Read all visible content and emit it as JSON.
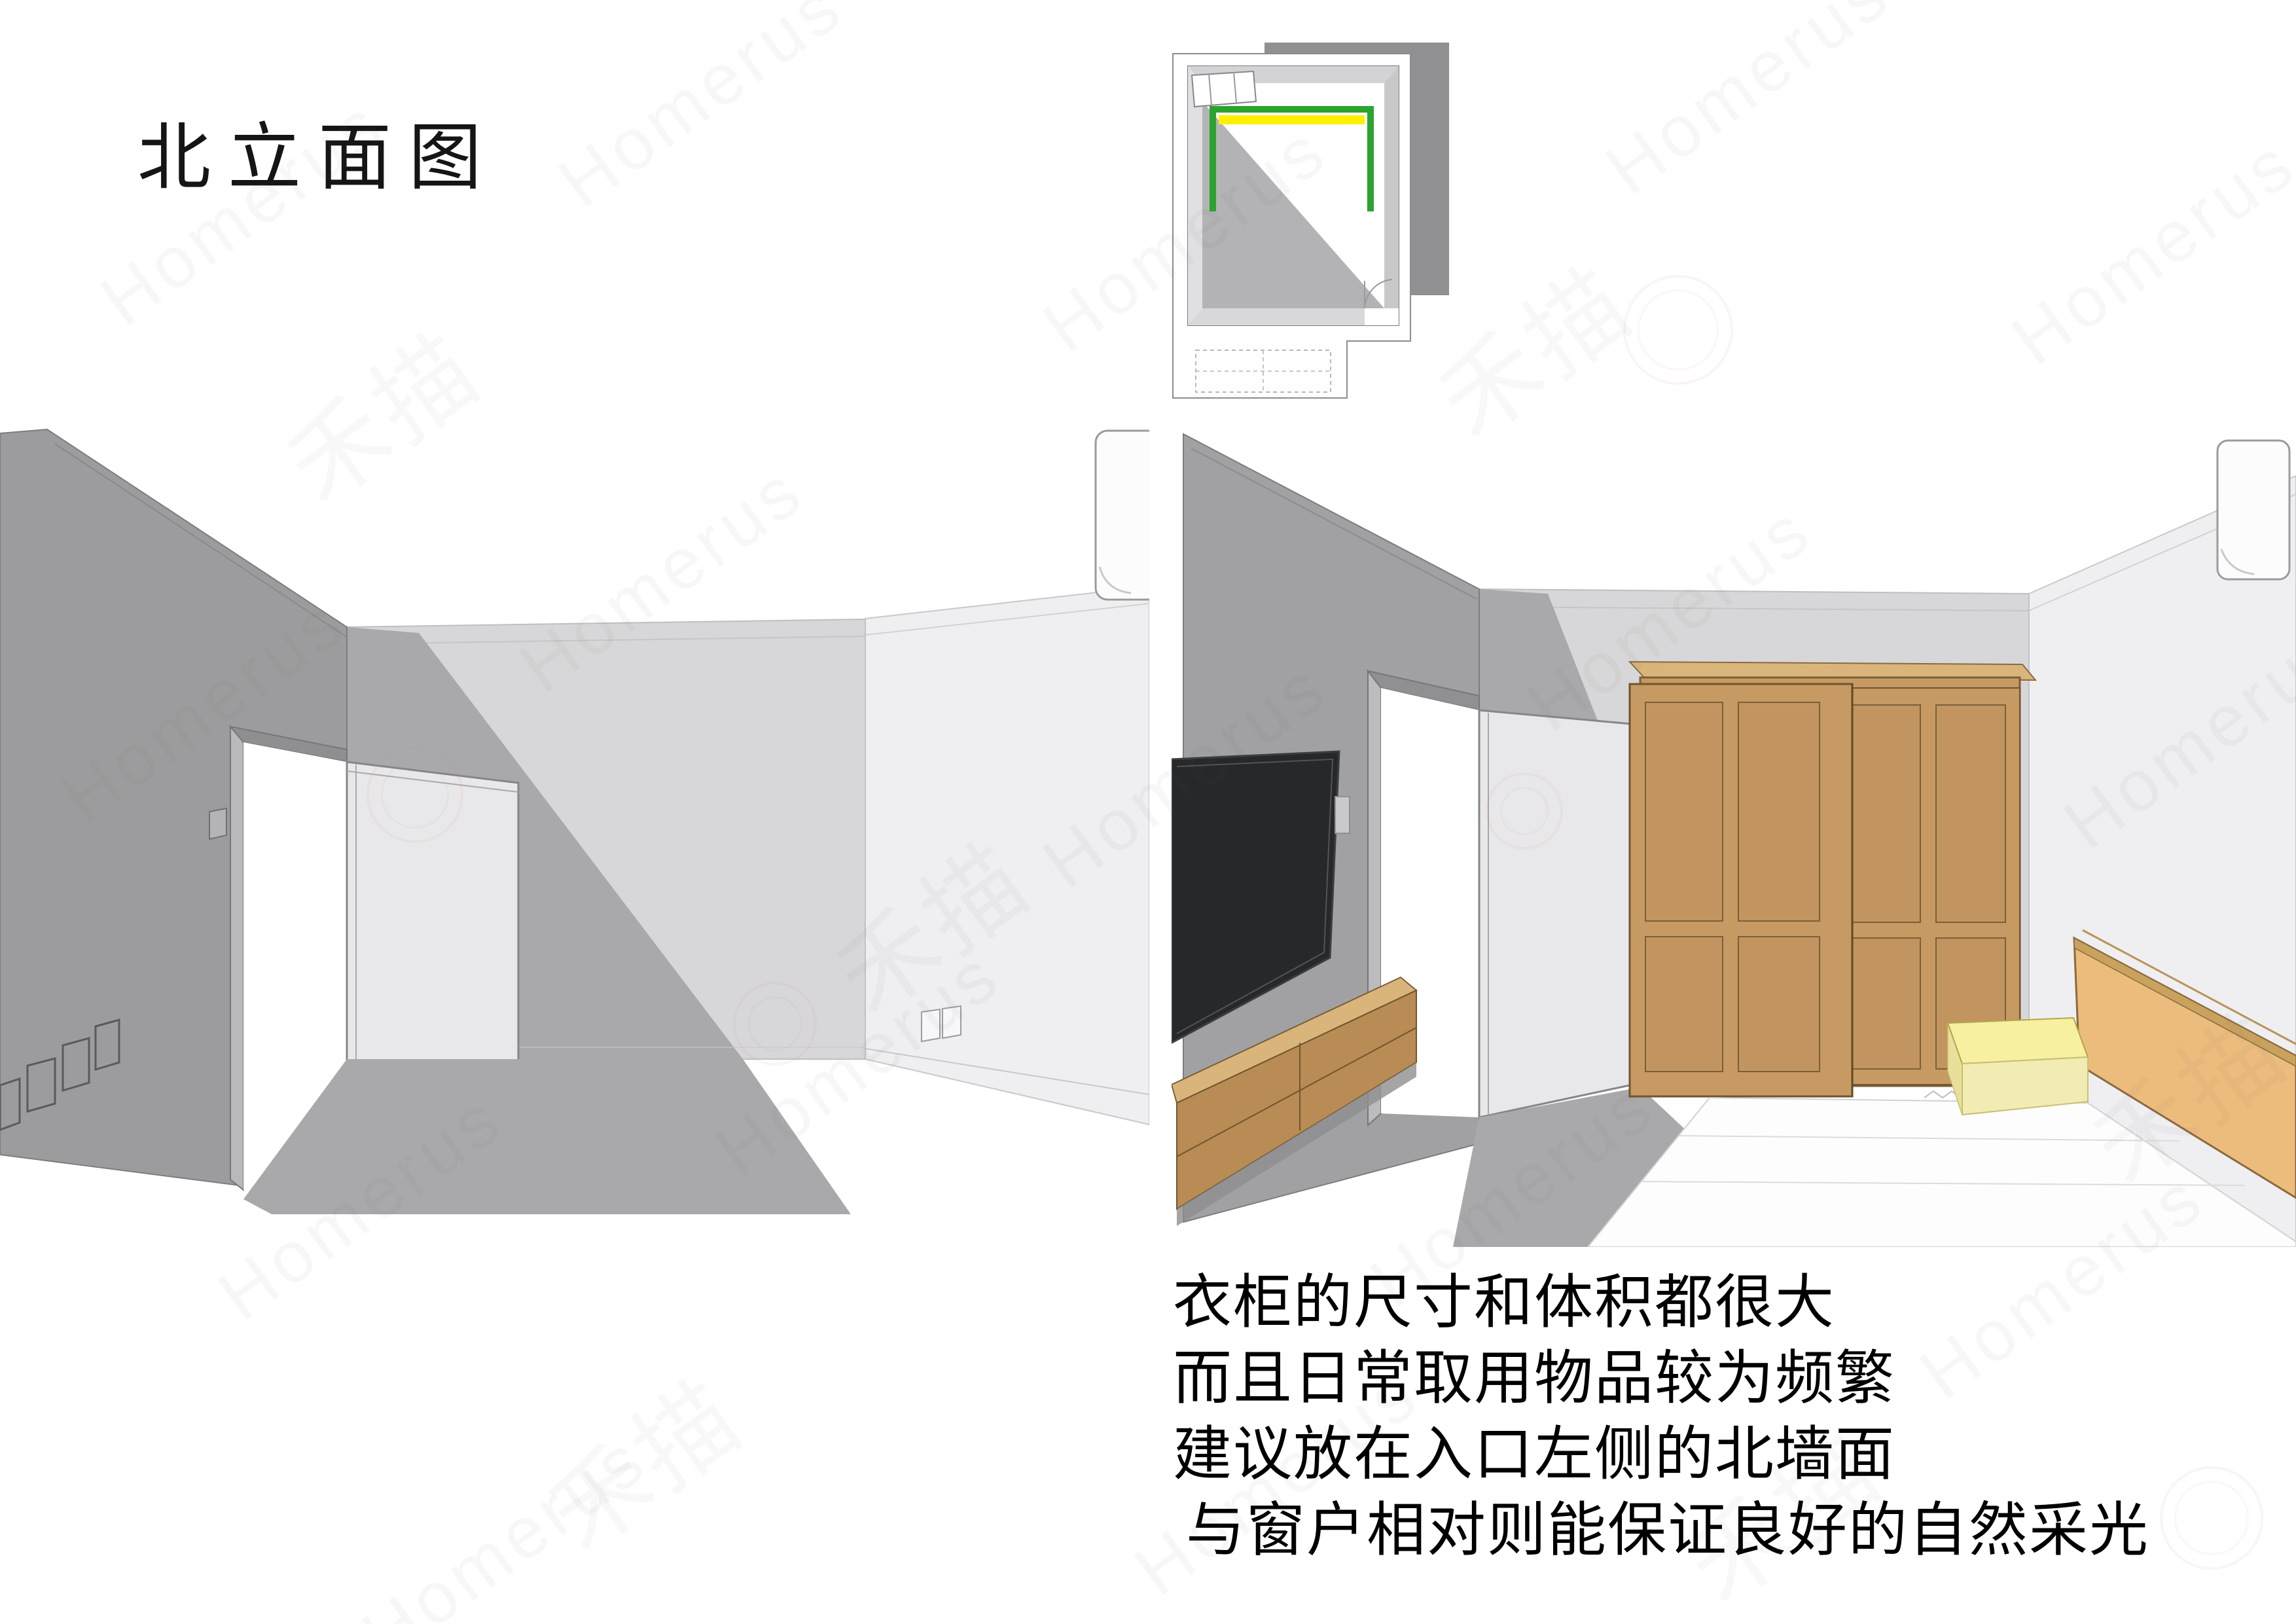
{
  "title": "北立面图",
  "notes": [
    "衣柜的尺寸和体积都很大",
    "而且日常取用物品较为频繁",
    "建议放在入口左侧的北墙面",
    "与窗户相对则能保证良好的自然采光"
  ],
  "watermark": {
    "text": "Homerus",
    "logo_text": "禾描"
  },
  "plan": {
    "description": "axonometric room thumbnail with north wall highlighted",
    "highlight_green": "#2BA32E",
    "highlight_yellow": "#FFEF00"
  },
  "colors": {
    "wall_dark": "#9C9C9E",
    "wall_dark2": "#A1A1A3",
    "wall_back": "#D7D7D9",
    "wall_right": "#EFEFF1",
    "shadow": "#A9A9AB",
    "door_leaf": "#E8E8EA",
    "wood": "#C69A62",
    "wood_panel": "#C29560",
    "wood_dark": "#B88C54",
    "wood_light": "#D9B57B",
    "tv_screen": "#26282A",
    "headboard": "#ECBC7D",
    "headboard_edge": "#C9A25E",
    "nightstand_top": "#F7F0A0",
    "nightstand_front": "#F2EBB4",
    "nightstand_side": "#E8E09A",
    "green": "#2BA32E",
    "yellow": "#FFEF00",
    "text": "#0F0F0F"
  }
}
